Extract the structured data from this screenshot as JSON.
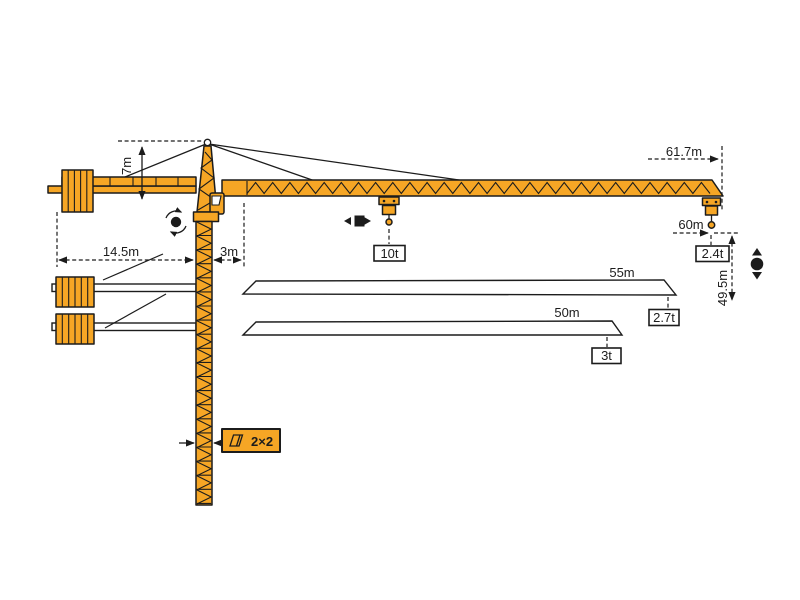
{
  "colors": {
    "crane_orange": "#F6A625",
    "line_black": "#1c1c1c",
    "background": "#ffffff"
  },
  "labels": {
    "head_height": "7m",
    "full_jib_length": "61.7m",
    "counterjib_radius": "14.5m",
    "mast_offset": "3m",
    "max_capacity": "10t",
    "working_radius": "60m",
    "tip_capacity": "2.4t",
    "hook_height": "49.5m",
    "mast_section": "2×2"
  },
  "jib_options": [
    {
      "length": "55m",
      "tip_capacity": "2.7t"
    },
    {
      "length": "50m",
      "tip_capacity": "3t"
    }
  ],
  "icons": {
    "slewing": "rotation-arrows",
    "trolley_travel": "left-right-arrows",
    "hoist": "up-down-arrows",
    "mast_section": "square-section"
  }
}
